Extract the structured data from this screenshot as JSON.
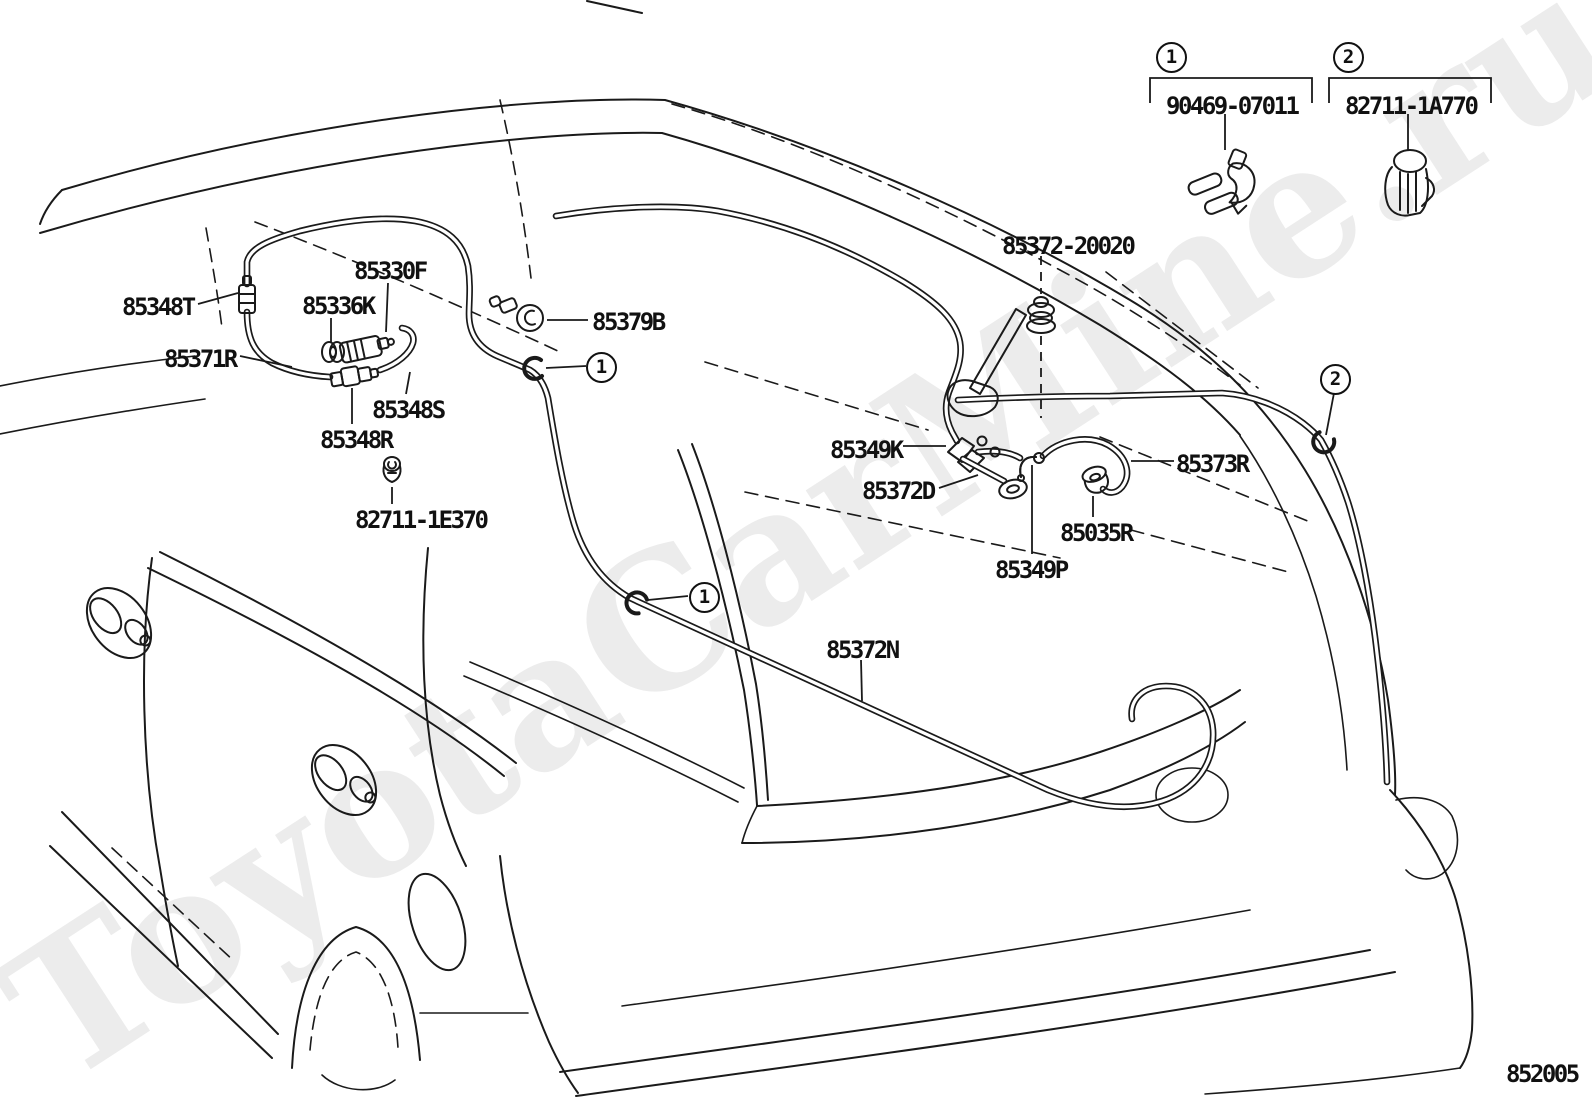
{
  "watermark": {
    "text": "ToyotaCarMine.ru"
  },
  "footer": {
    "diagram_code": "852005"
  },
  "markers": {
    "clip1": "1",
    "clip2": "2"
  },
  "legend": {
    "item1": {
      "ref": "1",
      "part_number": "90469-07011"
    },
    "item2": {
      "ref": "2",
      "part_number": "82711-1A770"
    }
  },
  "parts": {
    "p85348T": "85348T",
    "p85330F": "85330F",
    "p85336K": "85336K",
    "p85371R": "85371R",
    "p85348S": "85348S",
    "p85348R": "85348R",
    "p82711_1E370": "82711-1E370",
    "p85379B": "85379B",
    "p85372_20020": "85372-20020",
    "p85349K": "85349K",
    "p85372D": "85372D",
    "p85373R": "85373R",
    "p85035R": "85035R",
    "p85349P": "85349P",
    "p85372N": "85372N"
  },
  "colors": {
    "line": "#1a1a1a",
    "watermark": "#ececec"
  }
}
